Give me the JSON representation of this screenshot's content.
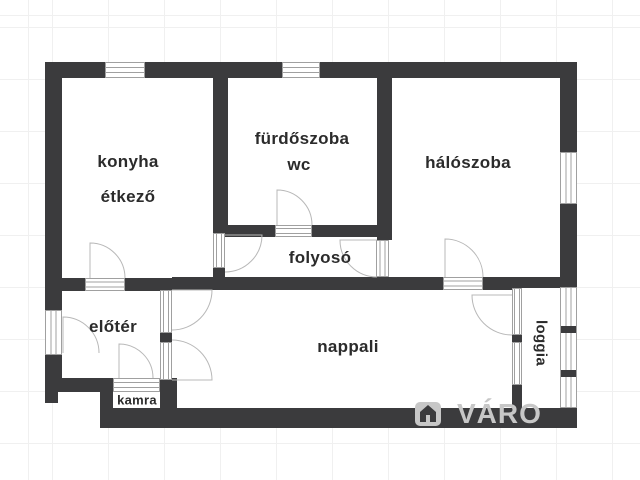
{
  "plan": {
    "type": "apartment-floor-plan",
    "rooms": [
      {
        "id": "konyha-etkezo",
        "lines": [
          "konyha",
          "étkező"
        ]
      },
      {
        "id": "furdoszoba-wc",
        "lines": [
          "fürdőszoba",
          "wc"
        ]
      },
      {
        "id": "haloszoba",
        "lines": [
          "hálószoba"
        ]
      },
      {
        "id": "folyoso",
        "lines": [
          "folyosó"
        ]
      },
      {
        "id": "eloter",
        "lines": [
          "előtér"
        ]
      },
      {
        "id": "nappali",
        "lines": [
          "nappali"
        ]
      },
      {
        "id": "kamra",
        "lines": [
          "kamra"
        ]
      },
      {
        "id": "loggia",
        "lines": [
          "loggia"
        ]
      }
    ]
  },
  "watermark": {
    "text": "VÁRO",
    "logo_icon": "house-logo-icon"
  },
  "colors": {
    "wall": "#3b3b3d",
    "room_label": "#2b2b2b",
    "window_frame": "#a0a0a0",
    "door_arc": "#b8b8b8",
    "watermark": "#c7c7c7",
    "grid": "#f0f0f0",
    "background": "#ffffff"
  }
}
